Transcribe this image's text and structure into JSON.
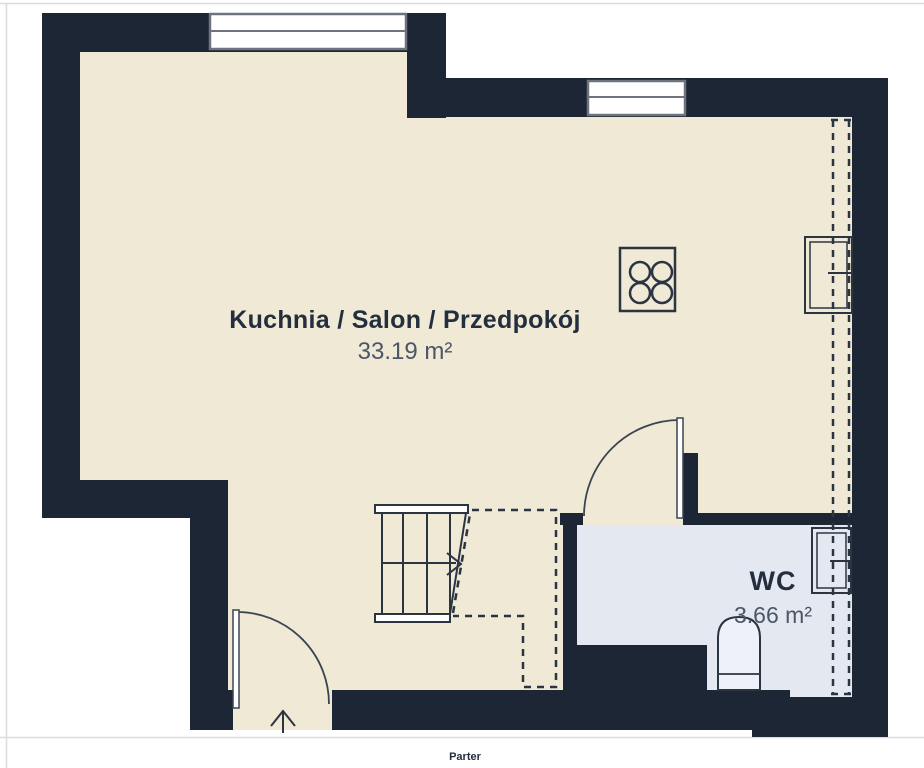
{
  "page": {
    "floor_label": "Parter"
  },
  "rooms": {
    "main": {
      "name": "Kuchnia / Salon / Przedpokój",
      "area": "33.19 m²"
    },
    "wc": {
      "name": "WC",
      "area": "3.66 m²"
    }
  },
  "colors": {
    "wall": "#1d2634",
    "floor": "#f0e9d5",
    "wc_floor": "#e4e8f1",
    "line": "#2b3542",
    "window_frame": "#6e747e",
    "text_primary": "#232e3e",
    "text_secondary": "#4b5666",
    "page_border": "#dcdcdc"
  }
}
